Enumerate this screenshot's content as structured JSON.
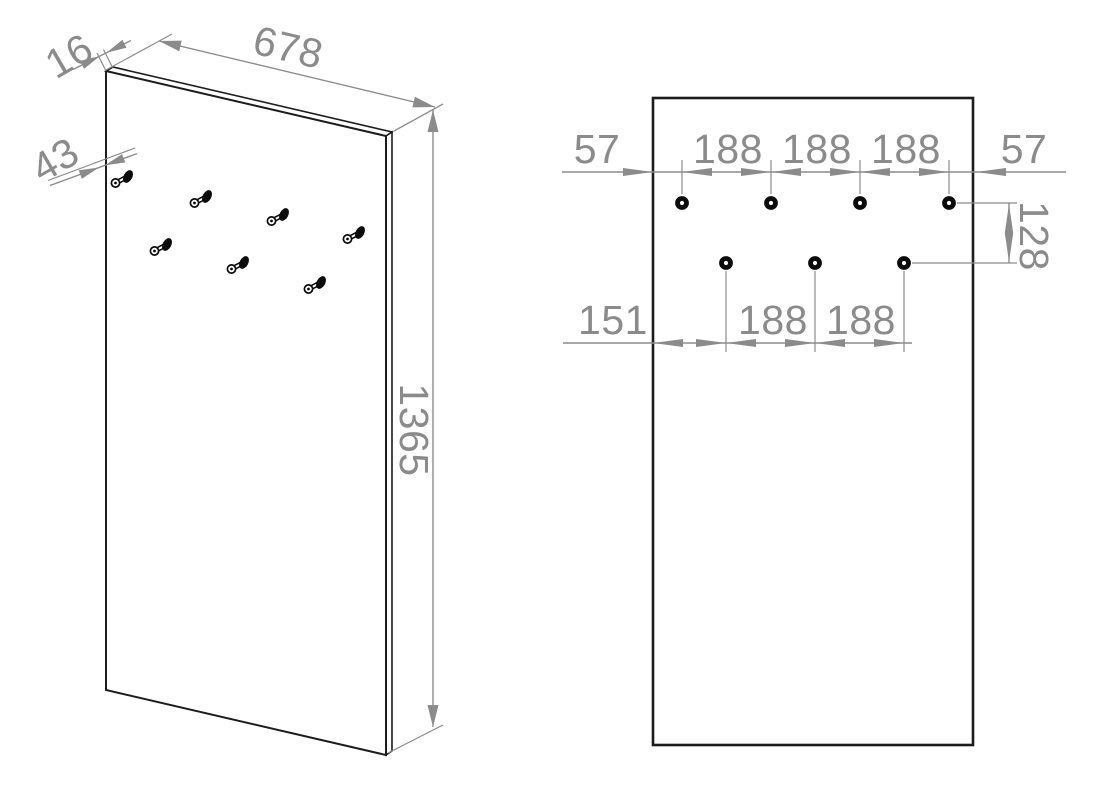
{
  "drawing": {
    "title": "wall-panel-with-hooks-dimension-drawing",
    "iso_view": {
      "thickness": "16",
      "width": "678",
      "hook_depth": "43",
      "height": "1365"
    },
    "front_view": {
      "top_dims": [
        "57",
        "188",
        "188",
        "188",
        "57"
      ],
      "row_spacing": "128",
      "bottom_dims": [
        "151",
        "188",
        "188"
      ]
    },
    "colors": {
      "dimension_gray": "#8b8b8b",
      "outline_black": "#1c1c1c",
      "background": "#ffffff"
    }
  }
}
